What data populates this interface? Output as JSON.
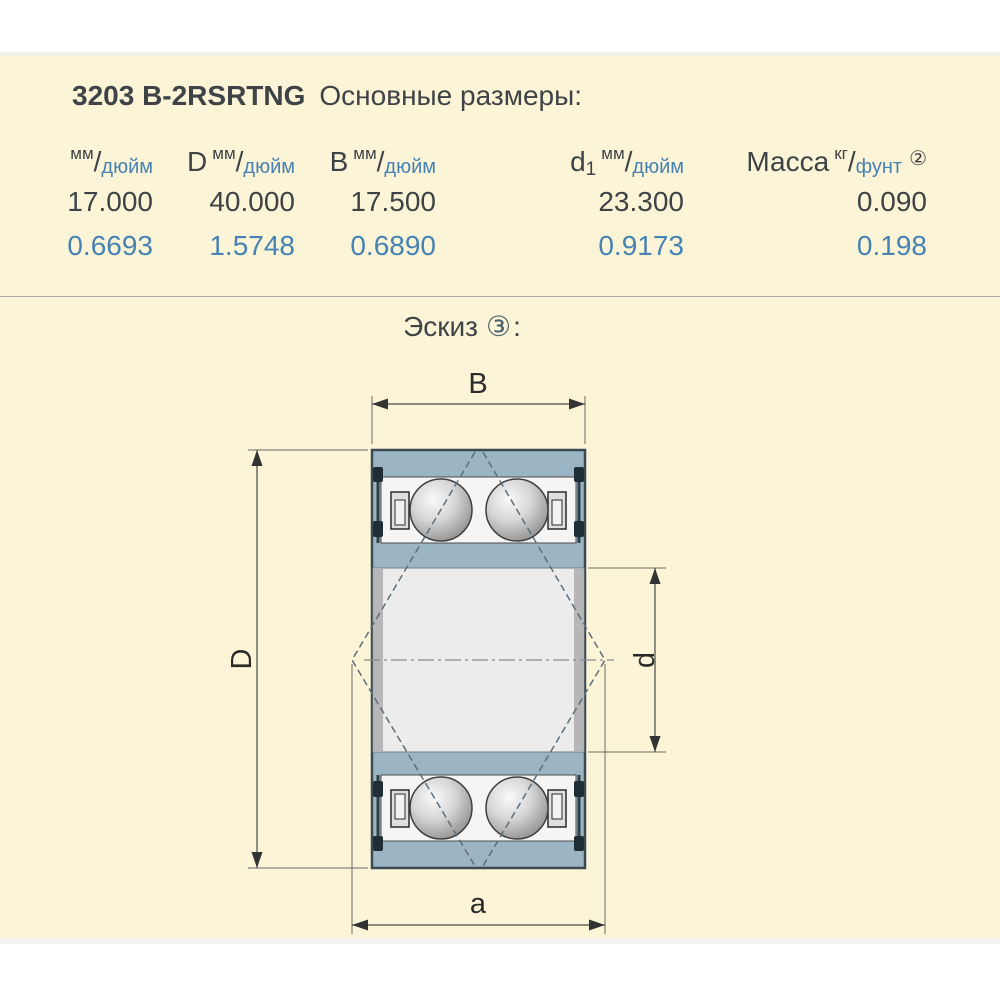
{
  "header": {
    "part_number": "3203 B-2RSRTNG",
    "section_title": "Основные размеры:"
  },
  "table": {
    "columns": [
      {
        "symbol": "",
        "symbol_sub": "",
        "unit_top": "мм",
        "unit_bottom": "дюйм",
        "note": ""
      },
      {
        "symbol": "D",
        "symbol_sub": "",
        "unit_top": "мм",
        "unit_bottom": "дюйм",
        "note": ""
      },
      {
        "symbol": "B",
        "symbol_sub": "",
        "unit_top": "мм",
        "unit_bottom": "дюйм",
        "note": ""
      },
      {
        "symbol": "d",
        "symbol_sub": "1",
        "unit_top": "мм",
        "unit_bottom": "дюйм",
        "note": ""
      },
      {
        "symbol": "Масса",
        "symbol_sub": "",
        "unit_top": "кг",
        "unit_bottom": "фунт",
        "note": "②"
      }
    ],
    "rows": [
      {
        "unit": "mm",
        "values": [
          "17.000",
          "40.000",
          "17.500",
          "23.300",
          "0.090"
        ]
      },
      {
        "unit": "inch",
        "values": [
          "0.6693",
          "1.5748",
          "0.6890",
          "0.9173",
          "0.198"
        ]
      }
    ]
  },
  "sketch": {
    "title": "Эскиз",
    "note": "③",
    "colon": ":",
    "labels": {
      "B": "B",
      "D": "D",
      "d": "d",
      "a": "a"
    }
  },
  "colors": {
    "background": "#FCF4D6",
    "accent_blue": "#4682B4",
    "text_dark": "#3E4347",
    "bearing_fill": "#9CB5C5",
    "bearing_outline": "#3A4A54"
  }
}
